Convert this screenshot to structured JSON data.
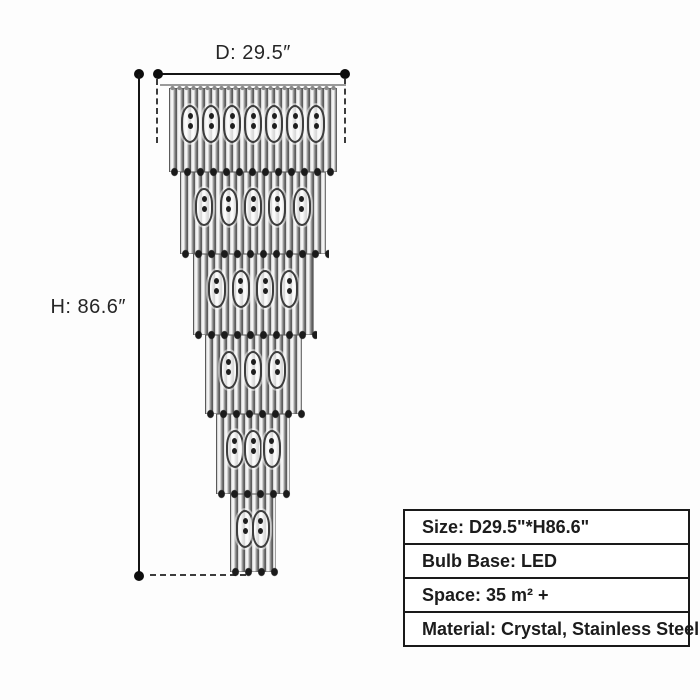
{
  "diagram": {
    "diameter_label": "D: 29.5″",
    "height_label": "H: 86.6″"
  },
  "chandelier": {
    "description": "six-tier tapered crystal rod chandelier",
    "tier_count": 6,
    "tiers": [
      {
        "width": 168,
        "height": 84,
        "bulbs": 7
      },
      {
        "width": 146,
        "height": 82,
        "bulbs": 5
      },
      {
        "width": 121,
        "height": 81,
        "bulbs": 4
      },
      {
        "width": 97,
        "height": 79,
        "bulbs": 3
      },
      {
        "width": 74,
        "height": 80,
        "bulbs": 3
      },
      {
        "width": 46,
        "height": 78,
        "bulbs": 2
      }
    ]
  },
  "spec_table": {
    "rows": [
      {
        "key": "size",
        "text": "Size: D29.5\"*H86.6\""
      },
      {
        "key": "bulb_base",
        "text": "Bulb Base: LED"
      },
      {
        "key": "space",
        "text": "Space: 35 m² +"
      },
      {
        "key": "material",
        "text": "Material: Crystal, Stainless Steel"
      }
    ]
  },
  "colors": {
    "background": "#fdfdfd",
    "line": "#141414",
    "table_border": "#1a1a1a",
    "rod_dark": "#5c5c5c",
    "rod_light": "#f4f4f4"
  }
}
